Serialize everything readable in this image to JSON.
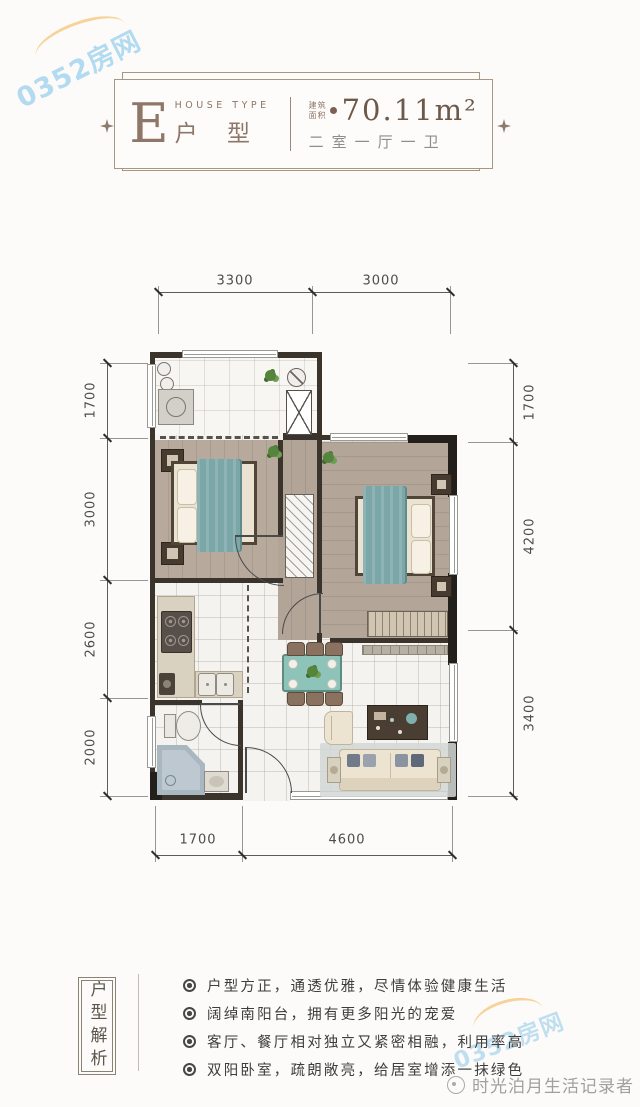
{
  "watermarks": {
    "site": "0352房网",
    "author": "时光泊月生活记录者"
  },
  "header": {
    "type_letter": "E",
    "type_label_en": "HOUSE TYPE",
    "type_label": "户 型",
    "area_label": "建筑面积",
    "area_value": "70.11m²",
    "layout_text": "二室一厅一卫"
  },
  "plan": {
    "dims_top": [
      "3300",
      "3000"
    ],
    "dims_left": [
      "1700",
      "3000",
      "2600",
      "2000"
    ],
    "dims_right": [
      "1700",
      "4200",
      "3400"
    ],
    "dims_bottom": [
      "1700",
      "4600"
    ]
  },
  "analysis": {
    "title": "户型解析",
    "bullets": [
      "户型方正，通透优雅，尽情体验健康生活",
      "阔绰南阳台，拥有更多阳光的宠爱",
      "客厅、餐厅相对独立又紧密相融，利用率高",
      "双阳卧室，疏朗敞亮，给居室增添一抹绿色"
    ]
  },
  "colors": {
    "accent_brown": "#8e7668",
    "teal_bed": "#7ca7a9",
    "wall_dark": "#3a342d",
    "watermark_blue": "#80c4eb",
    "watermark_orange": "#f3ba5f"
  }
}
